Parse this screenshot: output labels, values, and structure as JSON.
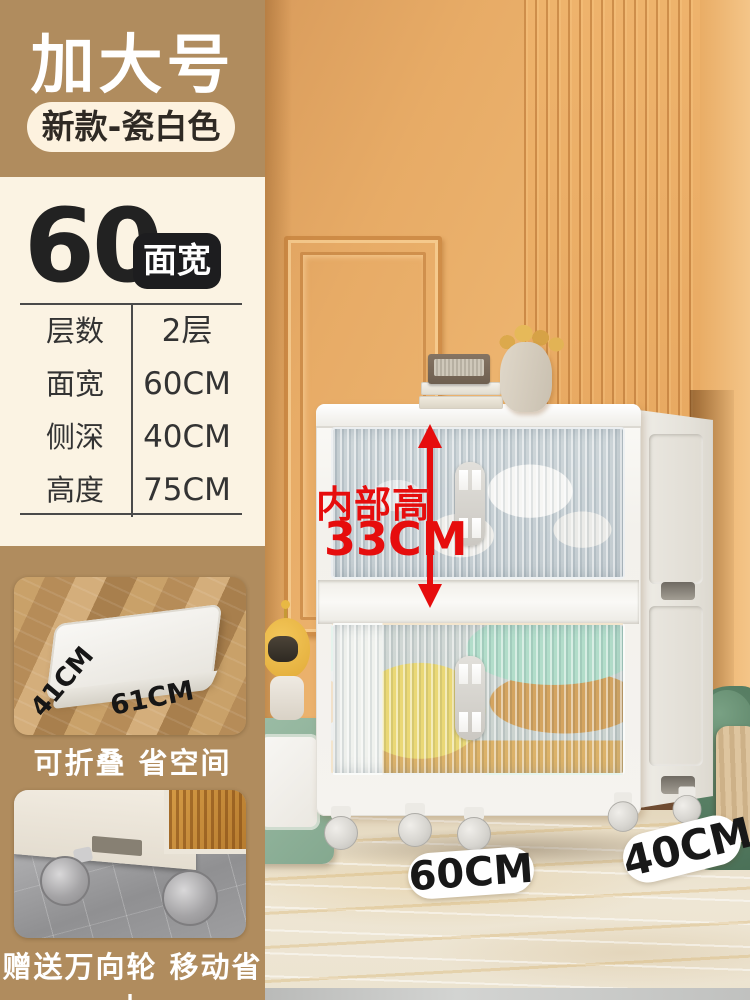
{
  "header": {
    "title": "加大号",
    "variant_badge": "新款-瓷白色"
  },
  "spec": {
    "big_value": "60",
    "big_unit_badge": "面宽",
    "rows": [
      {
        "label": "层数",
        "value": "2层"
      },
      {
        "label": "面宽",
        "value": "60CM"
      },
      {
        "label": "侧深",
        "value": "40CM"
      },
      {
        "label": "高度",
        "value": "75CM"
      }
    ]
  },
  "annotations": {
    "inner_height_label": "内部高",
    "inner_height_value": "33CM",
    "front_width_pill": "60CM",
    "side_depth_pill": "40CM"
  },
  "features": {
    "fold": {
      "caption": "可折叠 省空间",
      "folded_depth": "41CM",
      "folded_width": "61CM"
    },
    "wheels": {
      "caption": "赠送万向轮 移动省力"
    }
  },
  "colors": {
    "accent_red": "#e60d0d",
    "panel_tan": "#b08c5e",
    "panel_cream": "#fbf3e3",
    "badge_black": "#1d1d1f"
  }
}
